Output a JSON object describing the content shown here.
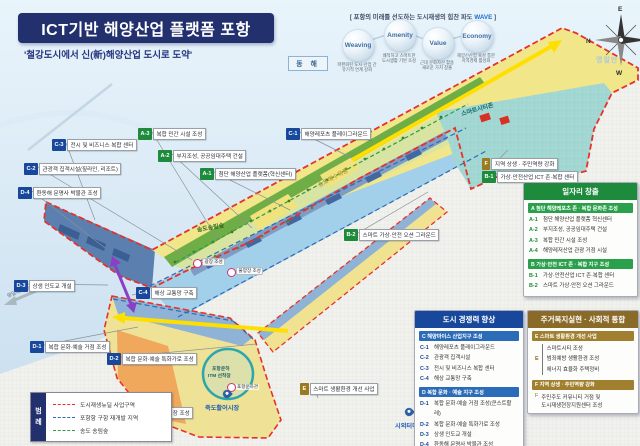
{
  "title": {
    "main": "ICT기반 해양산업 플랫폼 포항",
    "subtitle": "'철강도시에서 신(新)해양산업 도시로 도약'"
  },
  "wave": {
    "header_prefix": "[ 포항의 미래를 선도하는 도시재생의 힘찬 파도 ",
    "header_highlight": "WAVE",
    "header_suffix": " ]",
    "bubbles": [
      {
        "label": "Weaving",
        "caption": "파편화된 도시·산업 간\n유기적 연계 강화"
      },
      {
        "label": "Amenity",
        "caption": "쾌적하고 스마트한\n도시생활 기반 조성"
      },
      {
        "label": "Value",
        "caption": "근대 문화자산 활용\n새로운 가치 창출"
      },
      {
        "label": "Economy",
        "caption": "해양신산업 육성 통한\n지역경제 활성화"
      }
    ]
  },
  "compass": {
    "n": "N",
    "e": "E",
    "s": "S",
    "w": "W"
  },
  "sea_chip": "동 해",
  "map_labels": [
    {
      "code": "A-3",
      "c": "g",
      "text": "복합 민간 시설 조성",
      "x": 138,
      "y": 128,
      "lx": 218,
      "ly": 240
    },
    {
      "code": "C-3",
      "c": "b",
      "text": "전시 및 비즈니스 복합 센터",
      "x": 52,
      "y": 139,
      "lx": 95,
      "ly": 220
    },
    {
      "code": "A-2",
      "c": "g",
      "text": "부지조성, 공공임대주택 건설",
      "x": 158,
      "y": 150,
      "lx": 252,
      "ly": 228
    },
    {
      "code": "C-2",
      "c": "b",
      "text": "관광객 집객시설(짚라인, 리조트)",
      "x": 24,
      "y": 163,
      "lx": 192,
      "ly": 260
    },
    {
      "code": "A-1",
      "c": "g",
      "text": "첨단 해양산업 플랫폼(혁신센터)",
      "x": 200,
      "y": 168,
      "lx": 290,
      "ly": 210
    },
    {
      "code": "D-4",
      "c": "b",
      "text": "환동해 문명사 박물관 조성",
      "x": 18,
      "y": 187,
      "lx": 105,
      "ly": 248
    },
    {
      "code": "C-1",
      "c": "b",
      "text": "해양레포츠 플레이그라운드",
      "x": 286,
      "y": 128,
      "lx": 352,
      "ly": 158
    },
    {
      "code": "F",
      "c": "o",
      "text": "지역 상생 · 주민역량 강화",
      "x": 482,
      "y": 158,
      "lx": 508,
      "ly": 150
    },
    {
      "code": "B-1",
      "c": "g",
      "text": "가상·안전산업 ICT 존·복합 센터",
      "x": 482,
      "y": 171,
      "lx": 505,
      "ly": 162
    },
    {
      "code": "B-2",
      "c": "g",
      "text": "스마트 가상·안전 오션 그라운드",
      "x": 344,
      "y": 229,
      "lx": 428,
      "ly": 192
    },
    {
      "code": "D-3",
      "c": "b",
      "text": "상생 인도교 개설",
      "x": 14,
      "y": 280,
      "lx": 108,
      "ly": 285
    },
    {
      "code": "C-4",
      "c": "b",
      "text": "해상 교통망 구축",
      "x": 136,
      "y": 287,
      "lx": 132,
      "ly": 295
    },
    {
      "code": "D-1",
      "c": "b",
      "text": "복합 문화·예술 거점 조성",
      "x": 30,
      "y": 341,
      "lx": 138,
      "ly": 327
    },
    {
      "code": "D-2",
      "c": "b",
      "text": "복합 문화·예술 특화가로 조성",
      "x": 107,
      "y": 353,
      "lx": 256,
      "ly": 344
    },
    {
      "code": "E",
      "c": "o",
      "text": "스마트 생활환경 개선 사업",
      "x": 300,
      "y": 383,
      "lx": 318,
      "ly": 398
    },
    {
      "code": "D-5",
      "c": "b",
      "text": "수산 특화시장 조성",
      "x": 127,
      "y": 407,
      "lx": 168,
      "ly": 398
    }
  ],
  "map_texts": [
    {
      "t": "송도송림숲",
      "cls": "t-forest",
      "x": 196,
      "y": 225,
      "rot": -10
    },
    {
      "t": "스마트시티존",
      "cls": "t-teal",
      "x": 460,
      "y": 109,
      "rot": -16
    },
    {
      "t": "송도해수욕장",
      "cls": "t-sand",
      "x": 316,
      "y": 181,
      "rot": -28
    },
    {
      "t": "영일대 해수욕장",
      "cls": "t-gray",
      "x": 6,
      "y": 293,
      "rot": -22
    },
    {
      "t": "죽도활어시장",
      "cls": "t-pin",
      "x": 205,
      "y": 403,
      "rot": 0
    },
    {
      "t": "시외터미널",
      "cls": "t-pin",
      "x": 395,
      "y": 421,
      "rot": 0
    },
    {
      "t": "고속도로",
      "cls": "t-gray",
      "x": 430,
      "y": 412,
      "rot": 18
    },
    {
      "t": "포항운하관",
      "cls": "t-tiny",
      "x": 236,
      "y": 384,
      "rot": 0
    },
    {
      "t": "포항운하",
      "cls": "t-canal",
      "x": 212,
      "y": 365,
      "rot": 0
    },
    {
      "t": "ITM 선착장",
      "cls": "t-canal",
      "x": 208,
      "y": 372,
      "rot": 0
    },
    {
      "t": "광장 조성",
      "cls": "t-pill",
      "x": 202,
      "y": 258,
      "rot": 0
    },
    {
      "t": "물양장 조성",
      "cls": "t-pill",
      "x": 236,
      "y": 267,
      "rot": 0
    },
    {
      "t": "영일만",
      "cls": "t-sea-faint",
      "x": 596,
      "y": 55,
      "rot": 0
    }
  ],
  "markers": [
    {
      "type": "ring",
      "x": 193,
      "y": 259
    },
    {
      "type": "ring",
      "x": 227,
      "y": 268
    },
    {
      "type": "ring",
      "x": 227,
      "y": 383
    },
    {
      "type": "pin",
      "x": 223,
      "y": 390
    },
    {
      "type": "pin",
      "x": 405,
      "y": 408
    }
  ],
  "legend": {
    "tab": "범례",
    "items": [
      {
        "color": "#e8312a",
        "label": "도시재생뉴딜 사업구역"
      },
      {
        "color": "#2b6cb8",
        "label": "포항항 구항 재개발 지역"
      },
      {
        "color": "#2f9e44",
        "label": "송도 송림숲"
      }
    ]
  },
  "boxes": {
    "jobs": {
      "title": "일자리 창출",
      "sections": [
        {
          "band": "A  첨단 해양레포츠 존 · 복합 문화존 조성",
          "items": [
            [
              "A-1",
              "첨단 해양산업 플랫폼 혁신센터"
            ],
            [
              "A-2",
              "부지조성, 공공임대주택 건설"
            ],
            [
              "A-3",
              "복합 민간 시설 조성"
            ],
            [
              "A-4",
              "해양레저산업 관광 거점 시설"
            ]
          ]
        },
        {
          "band": "B  가상·안전 ICT 존 · 복합 지구 조성",
          "items": [
            [
              "B-1",
              "가상·안전산업 ICT 존·복합 센터"
            ],
            [
              "B-2",
              "스마트 가상·안전 오션 그라운드"
            ]
          ]
        }
      ]
    },
    "city": {
      "title": "도시 경쟁력 향상",
      "sections": [
        {
          "band": "C  해양마이스 산업지구 조성",
          "items": [
            [
              "C-1",
              "해양레포츠 플레이그라운드"
            ],
            [
              "C-2",
              "관광객 집객시설"
            ],
            [
              "C-3",
              "전시 및 비즈니스 복합 센터"
            ],
            [
              "C-4",
              "해상 교통망 구축"
            ]
          ]
        },
        {
          "band": "D  복합 문화 · 예술 지구 조성",
          "items": [
            [
              "D-1",
              "복합 문화·예술 거점 조성(쿤스트할레)"
            ],
            [
              "D-2",
              "복합 문화·예술 특화가로 조성"
            ],
            [
              "D-3",
              "상생 인도교 개설"
            ],
            [
              "D-4",
              "환동해 문명사 박물관 조성"
            ],
            [
              "D-5",
              "수산 특화시장 조성"
            ]
          ]
        }
      ]
    },
    "welfare": {
      "title": "주거복지실현 · 사회적 통합",
      "e_band": "E  스마트 생활환경 개선 사업",
      "e_label": "E",
      "e_items": [
        "스마트시티 조성",
        "범죄예방 생활환경 조성",
        "에너지 효율화 주택정비"
      ],
      "f_band": "F  지역 상생 · 주민역량 강화",
      "f_label": "F",
      "f_text": "주민주도 커뮤니티 거점 및\n도시재생현장지원센터 조성"
    }
  }
}
